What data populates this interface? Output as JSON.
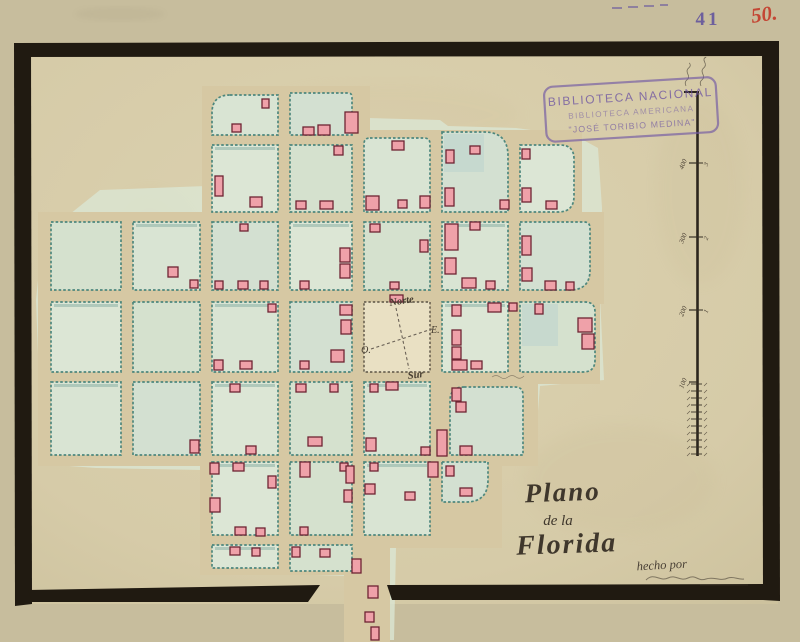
{
  "annotations": {
    "catalog_number": "41",
    "collection_number": "50.",
    "credit": "hecho por"
  },
  "stamp": {
    "line1": "BIBLIOTECA NACIONAL",
    "line2": "BIBLIOTECA AMERICANA",
    "line3": "\"JOSÉ TORIBIO MEDINA\""
  },
  "title": {
    "line1": "Plano",
    "line2": "de la",
    "line3": "Florida"
  },
  "compass": {
    "north": "Norte",
    "south": "Sur",
    "east": "E.",
    "west": "O."
  },
  "scalebar": {
    "x": 697,
    "top": 92,
    "bottom": 456,
    "left_ticks": [
      {
        "y": 163,
        "label": "400"
      },
      {
        "y": 237,
        "label": "300"
      },
      {
        "y": 310,
        "label": "200"
      },
      {
        "y": 382,
        "label": "100"
      }
    ],
    "right_ticks": [
      {
        "y": 163,
        "label": "3"
      },
      {
        "y": 237,
        "label": "2"
      },
      {
        "y": 310,
        "label": "1"
      }
    ],
    "dense": {
      "from": 384,
      "to": 456,
      "step": 7
    }
  },
  "map": {
    "colors": {
      "mat": "#c7bd9d",
      "paper": "#d8cdab",
      "street": "#d6c8a3",
      "block_stroke": "#4d877d",
      "wash": "#dbe6d3",
      "building": "#efa1a9",
      "building_stroke": "#6e2433",
      "frame": "#201a11",
      "plaza": "#e9e0c3",
      "ink": "#43392e",
      "stamp": "#7158a4",
      "red": "#c44634"
    },
    "wash": "70,214 100,190 206,186 206,92 282,88 286,92 360,86 368,118 440,120 448,126 516,128 576,136 598,148 602,208 600,296 604,380 540,386 534,462 498,466 494,510 444,514 440,542 396,548 394,640 350,640 348,576 282,574 280,546 206,544 202,470 96,468 42,464 36,300 44,220",
    "plates": [
      [
        202,
        86,
        168,
        64
      ],
      [
        202,
        130,
        380,
        94
      ],
      [
        38,
        212,
        566,
        92
      ],
      [
        38,
        292,
        562,
        92
      ],
      [
        38,
        372,
        500,
        94
      ],
      [
        200,
        452,
        302,
        96
      ],
      [
        200,
        535,
        162,
        40
      ],
      [
        344,
        548,
        46,
        94
      ]
    ],
    "blocks": [
      [
        212,
        95,
        66,
        40,
        [
          18,
          0,
          0,
          0
        ]
      ],
      [
        290,
        93,
        62,
        42,
        [
          0,
          4,
          0,
          0
        ]
      ],
      [
        212,
        145,
        66,
        67
      ],
      [
        290,
        145,
        62,
        67
      ],
      [
        364,
        138,
        66,
        74,
        [
          6,
          6,
          0,
          0
        ]
      ],
      [
        442,
        132,
        66,
        80,
        [
          0,
          24,
          0,
          0
        ]
      ],
      [
        520,
        145,
        54,
        67,
        [
          0,
          14,
          16,
          0
        ]
      ],
      [
        51,
        222,
        70,
        68
      ],
      [
        133,
        222,
        67,
        68
      ],
      [
        212,
        222,
        66,
        68
      ],
      [
        290,
        222,
        62,
        68
      ],
      [
        364,
        222,
        66,
        68
      ],
      [
        442,
        222,
        66,
        68
      ],
      [
        520,
        222,
        70,
        68,
        [
          0,
          6,
          20,
          0
        ]
      ],
      [
        51,
        302,
        70,
        70
      ],
      [
        133,
        302,
        67,
        70
      ],
      [
        212,
        302,
        66,
        70
      ],
      [
        290,
        302,
        62,
        70
      ],
      [
        442,
        302,
        66,
        70
      ],
      [
        520,
        302,
        75,
        70,
        [
          0,
          10,
          12,
          0
        ]
      ],
      [
        51,
        382,
        70,
        73
      ],
      [
        133,
        382,
        67,
        73
      ],
      [
        212,
        382,
        66,
        73
      ],
      [
        290,
        382,
        62,
        73
      ],
      [
        364,
        382,
        66,
        73
      ],
      [
        450,
        387,
        73,
        68,
        [
          14,
          8,
          0,
          0
        ]
      ],
      [
        212,
        462,
        66,
        73
      ],
      [
        290,
        462,
        62,
        73
      ],
      [
        364,
        462,
        66,
        73
      ],
      [
        442,
        462,
        46,
        40,
        [
          0,
          0,
          22,
          0
        ]
      ],
      [
        212,
        545,
        66,
        23
      ],
      [
        290,
        545,
        62,
        26
      ]
    ],
    "plaza": [
      364,
      302,
      66,
      70
    ],
    "patches": [
      [
        522,
        304,
        36,
        42
      ],
      [
        444,
        134,
        40,
        38
      ]
    ],
    "buildings": [
      [
        262,
        99,
        7,
        9
      ],
      [
        232,
        124,
        9,
        8
      ],
      [
        303,
        127,
        11,
        8
      ],
      [
        318,
        125,
        12,
        10
      ],
      [
        345,
        112,
        13,
        21
      ],
      [
        392,
        141,
        12,
        9
      ],
      [
        398,
        200,
        9,
        8
      ],
      [
        366,
        196,
        13,
        14
      ],
      [
        420,
        196,
        10,
        12
      ],
      [
        215,
        176,
        8,
        20
      ],
      [
        250,
        197,
        12,
        10
      ],
      [
        296,
        201,
        10,
        8
      ],
      [
        320,
        201,
        13,
        8
      ],
      [
        334,
        146,
        9,
        9
      ],
      [
        446,
        150,
        8,
        13
      ],
      [
        445,
        188,
        9,
        18
      ],
      [
        500,
        200,
        9,
        9
      ],
      [
        470,
        146,
        10,
        8
      ],
      [
        522,
        149,
        8,
        10
      ],
      [
        522,
        188,
        9,
        14
      ],
      [
        546,
        201,
        11,
        8
      ],
      [
        168,
        267,
        10,
        10
      ],
      [
        190,
        280,
        8,
        8
      ],
      [
        215,
        281,
        8,
        8
      ],
      [
        238,
        281,
        10,
        8
      ],
      [
        260,
        281,
        8,
        8
      ],
      [
        240,
        224,
        8,
        7
      ],
      [
        340,
        248,
        10,
        14
      ],
      [
        340,
        264,
        10,
        14
      ],
      [
        300,
        281,
        9,
        8
      ],
      [
        370,
        224,
        10,
        8
      ],
      [
        420,
        240,
        8,
        12
      ],
      [
        390,
        282,
        9,
        7
      ],
      [
        445,
        224,
        13,
        26
      ],
      [
        445,
        258,
        11,
        16
      ],
      [
        470,
        222,
        10,
        8
      ],
      [
        462,
        278,
        14,
        10
      ],
      [
        486,
        281,
        9,
        8
      ],
      [
        522,
        236,
        9,
        19
      ],
      [
        522,
        268,
        10,
        13
      ],
      [
        545,
        281,
        11,
        9
      ],
      [
        566,
        282,
        8,
        8
      ],
      [
        268,
        304,
        8,
        8
      ],
      [
        214,
        360,
        9,
        10
      ],
      [
        240,
        361,
        12,
        8
      ],
      [
        340,
        305,
        12,
        10
      ],
      [
        341,
        320,
        10,
        14
      ],
      [
        331,
        350,
        13,
        12
      ],
      [
        300,
        361,
        9,
        8
      ],
      [
        390,
        295,
        13,
        7
      ],
      [
        452,
        305,
        9,
        11
      ],
      [
        488,
        303,
        13,
        9
      ],
      [
        509,
        303,
        8,
        8
      ],
      [
        452,
        330,
        9,
        15
      ],
      [
        452,
        347,
        9,
        12
      ],
      [
        452,
        360,
        15,
        10
      ],
      [
        471,
        361,
        11,
        8
      ],
      [
        535,
        304,
        8,
        10
      ],
      [
        578,
        318,
        14,
        14
      ],
      [
        582,
        334,
        12,
        15
      ],
      [
        190,
        440,
        9,
        13
      ],
      [
        230,
        384,
        10,
        8
      ],
      [
        246,
        446,
        10,
        8
      ],
      [
        296,
        384,
        10,
        8
      ],
      [
        308,
        437,
        14,
        9
      ],
      [
        330,
        384,
        8,
        8
      ],
      [
        370,
        384,
        8,
        8
      ],
      [
        386,
        382,
        12,
        8
      ],
      [
        366,
        438,
        10,
        13
      ],
      [
        421,
        447,
        9,
        8
      ],
      [
        452,
        388,
        9,
        13
      ],
      [
        456,
        402,
        10,
        10
      ],
      [
        437,
        430,
        10,
        26
      ],
      [
        460,
        446,
        12,
        9
      ],
      [
        210,
        463,
        9,
        11
      ],
      [
        233,
        463,
        11,
        8
      ],
      [
        210,
        498,
        10,
        14
      ],
      [
        268,
        476,
        8,
        12
      ],
      [
        235,
        527,
        11,
        8
      ],
      [
        256,
        528,
        9,
        8
      ],
      [
        300,
        462,
        10,
        15
      ],
      [
        340,
        463,
        8,
        8
      ],
      [
        346,
        466,
        8,
        17
      ],
      [
        344,
        490,
        8,
        12
      ],
      [
        300,
        527,
        8,
        8
      ],
      [
        370,
        463,
        8,
        8
      ],
      [
        428,
        462,
        10,
        15
      ],
      [
        365,
        484,
        10,
        10
      ],
      [
        405,
        492,
        10,
        8
      ],
      [
        446,
        466,
        8,
        10
      ],
      [
        460,
        488,
        12,
        8
      ],
      [
        230,
        547,
        10,
        8
      ],
      [
        252,
        548,
        8,
        8
      ],
      [
        292,
        547,
        8,
        10
      ],
      [
        320,
        549,
        10,
        8
      ],
      [
        352,
        559,
        9,
        14
      ],
      [
        368,
        586,
        10,
        12
      ],
      [
        365,
        612,
        9,
        10
      ],
      [
        371,
        627,
        8,
        13
      ]
    ]
  }
}
